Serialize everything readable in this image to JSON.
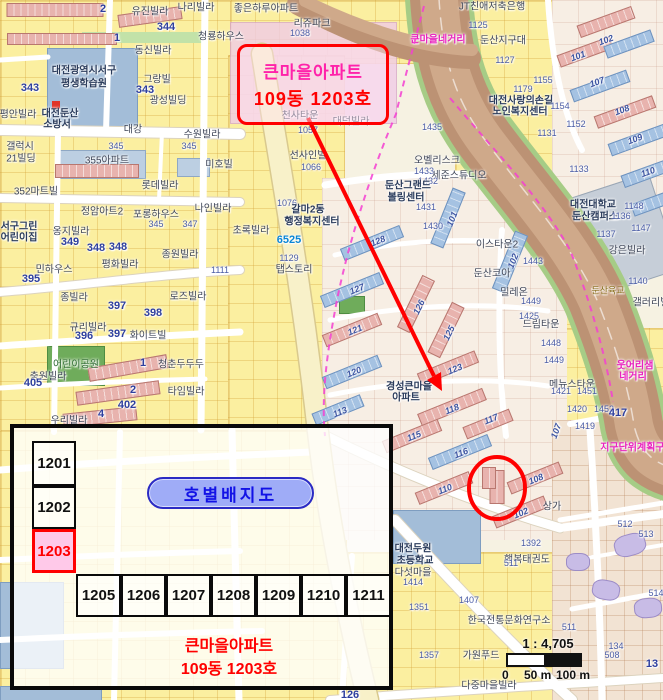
{
  "colors": {
    "red": "#FF0000",
    "magenta_boundary": "#F43FD2",
    "callout_pink": "#FF22AA",
    "pill_fill": "#9FACF7",
    "pill_text": "#1212E6",
    "highlight_fill": "#FFC9E9",
    "road_label_magenta": "#E823BE"
  },
  "callout": {
    "line1": "큰마을아파트",
    "line2": "109동 1203호"
  },
  "inset": {
    "title": "호별배지도",
    "left_units": [
      "1201",
      "1202",
      "1203"
    ],
    "highlight": "1203",
    "row_units": [
      "1205",
      "1206",
      "1207",
      "1208",
      "1209",
      "1210",
      "1211"
    ],
    "caption_line1": "큰마을아파트",
    "caption_line2": "109동 1203호"
  },
  "scalebar": {
    "ratio": "1 : 4,705",
    "tick_0": "0",
    "tick_50": "50 m",
    "tick_100": "100 m"
  },
  "map": {
    "labels": [
      {
        "t": "유진빌라",
        "x": 150,
        "y": 10
      },
      {
        "t": "나리빌라",
        "x": 196,
        "y": 6
      },
      {
        "t": "동신빌라",
        "x": 153,
        "y": 49
      },
      {
        "t": "청룡하우스",
        "x": 221,
        "y": 35
      },
      {
        "t": "344",
        "x": 166,
        "y": 27,
        "c": "numb"
      },
      {
        "t": "대전광역시서구",
        "x": 84,
        "y": 69,
        "c": "civic"
      },
      {
        "t": "평생학습원",
        "x": 84,
        "y": 82,
        "c": "civic"
      },
      {
        "t": "그랑빌",
        "x": 157,
        "y": 78
      },
      {
        "t": "343",
        "x": 30,
        "y": 88,
        "c": "numb"
      },
      {
        "t": "343",
        "x": 145,
        "y": 90,
        "c": "numb"
      },
      {
        "t": "광성빌딩",
        "x": 168,
        "y": 99
      },
      {
        "t": "평안빌라",
        "x": 18,
        "y": 113
      },
      {
        "t": "대전둔산",
        "x": 60,
        "y": 112,
        "c": "civic"
      },
      {
        "t": "소방서",
        "x": 57,
        "y": 123,
        "c": "civic"
      },
      {
        "t": "수원빌라",
        "x": 202,
        "y": 133
      },
      {
        "t": "대강",
        "x": 133,
        "y": 128
      },
      {
        "t": "갤럭시",
        "x": 20,
        "y": 145
      },
      {
        "t": "21빌딩",
        "x": 21,
        "y": 157
      },
      {
        "t": "345",
        "x": 116,
        "y": 146,
        "c": "num"
      },
      {
        "t": "345",
        "x": 189,
        "y": 146,
        "c": "num"
      },
      {
        "t": "355아파트",
        "x": 107,
        "y": 159
      },
      {
        "t": "미호빌",
        "x": 219,
        "y": 163
      },
      {
        "t": "롯데빌라",
        "x": 160,
        "y": 184
      },
      {
        "t": "352마트빌",
        "x": 36,
        "y": 190
      },
      {
        "t": "2",
        "x": 103,
        "y": 9,
        "c": "numb"
      },
      {
        "t": "1",
        "x": 117,
        "y": 38,
        "c": "numb"
      },
      {
        "t": "좋은하루아파트",
        "x": 266,
        "y": 7
      },
      {
        "t": "리쥬파크",
        "x": 312,
        "y": 22
      },
      {
        "t": "1038",
        "x": 300,
        "y": 33,
        "c": "num"
      },
      {
        "t": "큰마을네거리",
        "x": 438,
        "y": 38,
        "c": "mag"
      },
      {
        "t": "JT친애저축은행",
        "x": 492,
        "y": 5
      },
      {
        "t": "1125",
        "x": 478,
        "y": 25,
        "c": "num"
      },
      {
        "t": "둔산지구대",
        "x": 503,
        "y": 39
      },
      {
        "t": "1127",
        "x": 505,
        "y": 60,
        "c": "num"
      },
      {
        "t": "1155",
        "x": 543,
        "y": 80,
        "c": "num"
      },
      {
        "t": "1179",
        "x": 523,
        "y": 89,
        "c": "num"
      },
      {
        "t": "대전사랑의손길",
        "x": 521,
        "y": 99,
        "c": "civic"
      },
      {
        "t": "노인복지센터",
        "x": 520,
        "y": 110,
        "c": "civic"
      },
      {
        "t": "1154",
        "x": 560,
        "y": 106,
        "c": "num"
      },
      {
        "t": "1152",
        "x": 576,
        "y": 124,
        "c": "num"
      },
      {
        "t": "1131",
        "x": 547,
        "y": 133,
        "c": "num"
      },
      {
        "t": "1133",
        "x": 579,
        "y": 169,
        "c": "num"
      },
      {
        "t": "101",
        "x": 578,
        "y": 56,
        "c": "bn",
        "r": -20
      },
      {
        "t": "102",
        "x": 606,
        "y": 40,
        "c": "bn",
        "r": -20
      },
      {
        "t": "107",
        "x": 597,
        "y": 82,
        "c": "bn",
        "r": -20
      },
      {
        "t": "108",
        "x": 622,
        "y": 110,
        "c": "bn",
        "r": -20
      },
      {
        "t": "109",
        "x": 635,
        "y": 139,
        "c": "bn",
        "r": -20
      },
      {
        "t": "110",
        "x": 648,
        "y": 172,
        "c": "bn",
        "r": -20
      },
      {
        "t": "천사타운",
        "x": 300,
        "y": 114
      },
      {
        "t": "대덕빌라",
        "x": 351,
        "y": 120
      },
      {
        "t": "1057",
        "x": 308,
        "y": 130,
        "c": "num"
      },
      {
        "t": "선사인빌",
        "x": 308,
        "y": 154
      },
      {
        "t": "1066",
        "x": 311,
        "y": 167,
        "c": "num"
      },
      {
        "t": "1435",
        "x": 432,
        "y": 127,
        "c": "num"
      },
      {
        "t": "오벨리스크",
        "x": 437,
        "y": 159
      },
      {
        "t": "1433",
        "x": 424,
        "y": 171,
        "c": "num"
      },
      {
        "t": "세준스튜디오",
        "x": 459,
        "y": 174
      },
      {
        "t": "1432",
        "x": 428,
        "y": 181,
        "c": "num"
      },
      {
        "t": "둔산그랜드",
        "x": 408,
        "y": 184,
        "c": "civic"
      },
      {
        "t": "볼링센터",
        "x": 406,
        "y": 196,
        "c": "civic"
      },
      {
        "t": "1431",
        "x": 426,
        "y": 207,
        "c": "num"
      },
      {
        "t": "1430",
        "x": 433,
        "y": 226,
        "c": "num"
      },
      {
        "t": "1076",
        "x": 287,
        "y": 203,
        "c": "num"
      },
      {
        "t": "갈마2동",
        "x": 308,
        "y": 208,
        "c": "civic"
      },
      {
        "t": "행정복지센터",
        "x": 312,
        "y": 220,
        "c": "civic"
      },
      {
        "t": "초록빌라",
        "x": 251,
        "y": 229
      },
      {
        "t": "6525",
        "x": 289,
        "y": 240,
        "c": "cyan"
      },
      {
        "t": "1129",
        "x": 289,
        "y": 258,
        "c": "num"
      },
      {
        "t": "탭스토리",
        "x": 294,
        "y": 268
      },
      {
        "t": "128",
        "x": 378,
        "y": 241,
        "c": "bn",
        "r": -22
      },
      {
        "t": "101",
        "x": 452,
        "y": 219,
        "c": "bn",
        "r": -68
      },
      {
        "t": "102",
        "x": 513,
        "y": 261,
        "c": "bn",
        "r": -68
      },
      {
        "t": "127",
        "x": 357,
        "y": 289,
        "c": "bn",
        "r": -22
      },
      {
        "t": "126",
        "x": 419,
        "y": 307,
        "c": "bn",
        "r": -64
      },
      {
        "t": "121",
        "x": 355,
        "y": 330,
        "c": "bn",
        "r": -22
      },
      {
        "t": "125",
        "x": 449,
        "y": 333,
        "c": "bn",
        "r": -64
      },
      {
        "t": "120",
        "x": 354,
        "y": 372,
        "c": "bn",
        "r": -22
      },
      {
        "t": "123",
        "x": 455,
        "y": 369,
        "c": "bn",
        "r": -22
      },
      {
        "t": "113",
        "x": 340,
        "y": 412,
        "c": "bn",
        "r": -22
      },
      {
        "t": "118",
        "x": 452,
        "y": 409,
        "c": "bn",
        "r": -22
      },
      {
        "t": "117",
        "x": 491,
        "y": 419,
        "c": "bn",
        "r": -22
      },
      {
        "t": "115",
        "x": 414,
        "y": 436,
        "c": "bn",
        "r": -22
      },
      {
        "t": "116",
        "x": 461,
        "y": 453,
        "c": "bn",
        "r": -22
      },
      {
        "t": "110",
        "x": 445,
        "y": 489,
        "c": "bn",
        "r": -22
      },
      {
        "t": "108",
        "x": 536,
        "y": 479,
        "c": "bn",
        "r": -22
      },
      {
        "t": "102",
        "x": 521,
        "y": 513,
        "c": "bn",
        "r": -22
      },
      {
        "t": "107",
        "x": 556,
        "y": 431,
        "c": "bn",
        "r": -70
      },
      {
        "t": "경성큰마을",
        "x": 409,
        "y": 385,
        "c": "civic"
      },
      {
        "t": "아파트",
        "x": 406,
        "y": 396,
        "c": "civic"
      },
      {
        "t": "상가",
        "x": 552,
        "y": 505
      },
      {
        "t": "정암아트2",
        "x": 102,
        "y": 210
      },
      {
        "t": "포롱하우스",
        "x": 156,
        "y": 213
      },
      {
        "t": "나인빌라",
        "x": 213,
        "y": 207
      },
      {
        "t": "345",
        "x": 156,
        "y": 224,
        "c": "num"
      },
      {
        "t": "347",
        "x": 190,
        "y": 224,
        "c": "num"
      },
      {
        "t": "서구그린",
        "x": 19,
        "y": 225,
        "c": "civic"
      },
      {
        "t": "어린이집",
        "x": 19,
        "y": 236,
        "c": "civic"
      },
      {
        "t": "옹지빌라",
        "x": 71,
        "y": 230
      },
      {
        "t": "349",
        "x": 70,
        "y": 242,
        "c": "numb"
      },
      {
        "t": "348",
        "x": 96,
        "y": 248,
        "c": "numb"
      },
      {
        "t": "348",
        "x": 118,
        "y": 247,
        "c": "numb"
      },
      {
        "t": "종원빌라",
        "x": 180,
        "y": 253
      },
      {
        "t": "평화빌라",
        "x": 120,
        "y": 263
      },
      {
        "t": "민하우스",
        "x": 54,
        "y": 268
      },
      {
        "t": "395",
        "x": 31,
        "y": 279,
        "c": "numb"
      },
      {
        "t": "1111",
        "x": 220,
        "y": 270,
        "c": "num"
      },
      {
        "t": "종빌라",
        "x": 74,
        "y": 296
      },
      {
        "t": "로즈빌라",
        "x": 188,
        "y": 295
      },
      {
        "t": "397",
        "x": 117,
        "y": 306,
        "c": "numb"
      },
      {
        "t": "398",
        "x": 153,
        "y": 313,
        "c": "numb"
      },
      {
        "t": "규리빌라",
        "x": 88,
        "y": 326
      },
      {
        "t": "396",
        "x": 84,
        "y": 336,
        "c": "numb"
      },
      {
        "t": "397",
        "x": 117,
        "y": 334,
        "c": "numb"
      },
      {
        "t": "화이트빌",
        "x": 148,
        "y": 334
      },
      {
        "t": "어린이공원",
        "x": 76,
        "y": 363,
        "c": "green"
      },
      {
        "t": "충원빌라",
        "x": 48,
        "y": 375
      },
      {
        "t": "405",
        "x": 33,
        "y": 383,
        "c": "numb"
      },
      {
        "t": "청춘두두두",
        "x": 181,
        "y": 363
      },
      {
        "t": "타임빌라",
        "x": 186,
        "y": 390
      },
      {
        "t": "402",
        "x": 127,
        "y": 405,
        "c": "numb"
      },
      {
        "t": "우리빌라",
        "x": 69,
        "y": 419
      },
      {
        "t": "1",
        "x": 143,
        "y": 363,
        "c": "numb"
      },
      {
        "t": "2",
        "x": 133,
        "y": 390,
        "c": "numb"
      },
      {
        "t": "4",
        "x": 101,
        "y": 414,
        "c": "numb"
      },
      {
        "t": "이스타운2",
        "x": 497,
        "y": 243
      },
      {
        "t": "둔산코아",
        "x": 492,
        "y": 272
      },
      {
        "t": "1443",
        "x": 533,
        "y": 261,
        "c": "num"
      },
      {
        "t": "밀레온",
        "x": 514,
        "y": 291
      },
      {
        "t": "1449",
        "x": 531,
        "y": 301,
        "c": "num"
      },
      {
        "t": "1425",
        "x": 529,
        "y": 316,
        "c": "num"
      },
      {
        "t": "드림타운",
        "x": 541,
        "y": 323
      },
      {
        "t": "1448",
        "x": 551,
        "y": 343,
        "c": "num"
      },
      {
        "t": "1449",
        "x": 554,
        "y": 360,
        "c": "num"
      },
      {
        "t": "대전대학교",
        "x": 593,
        "y": 203,
        "c": "civic"
      },
      {
        "t": "둔산캠퍼스",
        "x": 595,
        "y": 215,
        "c": "civic"
      },
      {
        "t": "1136",
        "x": 621,
        "y": 216,
        "c": "num"
      },
      {
        "t": "1148",
        "x": 634,
        "y": 206,
        "c": "num"
      },
      {
        "t": "1137",
        "x": 606,
        "y": 234,
        "c": "num"
      },
      {
        "t": "1147",
        "x": 641,
        "y": 228,
        "c": "num"
      },
      {
        "t": "강은빌라",
        "x": 627,
        "y": 249
      },
      {
        "t": "1140",
        "x": 638,
        "y": 281,
        "c": "num"
      },
      {
        "t": "갤러리빌",
        "x": 651,
        "y": 301
      },
      {
        "t": "둔산육교",
        "x": 608,
        "y": 290,
        "c": "olive"
      },
      {
        "t": "메뉴스타운",
        "x": 572,
        "y": 383
      },
      {
        "t": "1421",
        "x": 561,
        "y": 391,
        "c": "num"
      },
      {
        "t": "1451",
        "x": 587,
        "y": 391,
        "c": "num"
      },
      {
        "t": "1420",
        "x": 577,
        "y": 409,
        "c": "num"
      },
      {
        "t": "1452",
        "x": 604,
        "y": 409,
        "c": "num"
      },
      {
        "t": "417",
        "x": 618,
        "y": 413,
        "c": "numb"
      },
      {
        "t": "1419",
        "x": 585,
        "y": 426,
        "c": "num"
      },
      {
        "t": "웃어리샘",
        "x": 635,
        "y": 364,
        "c": "mag"
      },
      {
        "t": "네거리",
        "x": 633,
        "y": 375,
        "c": "mag"
      },
      {
        "t": "지구단위계획구역",
        "x": 637,
        "y": 446,
        "c": "mag"
      },
      {
        "t": "대전두원",
        "x": 413,
        "y": 547,
        "c": "civic"
      },
      {
        "t": "초등학교",
        "x": 415,
        "y": 559,
        "c": "civic"
      },
      {
        "t": "행복태권도",
        "x": 527,
        "y": 558
      },
      {
        "t": "1392",
        "x": 531,
        "y": 543,
        "c": "num"
      },
      {
        "t": "다섯마을",
        "x": 413,
        "y": 571
      },
      {
        "t": "1414",
        "x": 413,
        "y": 582,
        "c": "num"
      },
      {
        "t": "1407",
        "x": 469,
        "y": 600,
        "c": "num"
      },
      {
        "t": "1351",
        "x": 419,
        "y": 607,
        "c": "num"
      },
      {
        "t": "한국전통문화연구소",
        "x": 509,
        "y": 619
      },
      {
        "t": "가원푸드",
        "x": 481,
        "y": 654
      },
      {
        "t": "1357",
        "x": 429,
        "y": 655,
        "c": "num"
      },
      {
        "t": "다중마을빌라",
        "x": 489,
        "y": 684
      },
      {
        "t": "511",
        "x": 511,
        "y": 563,
        "c": "num"
      },
      {
        "t": "511",
        "x": 569,
        "y": 627,
        "c": "num"
      },
      {
        "t": "512",
        "x": 625,
        "y": 524,
        "c": "num"
      },
      {
        "t": "513",
        "x": 646,
        "y": 534,
        "c": "num"
      },
      {
        "t": "514",
        "x": 656,
        "y": 593,
        "c": "num"
      },
      {
        "t": "508",
        "x": 612,
        "y": 655,
        "c": "num"
      },
      {
        "t": "13",
        "x": 652,
        "y": 664,
        "c": "numb"
      },
      {
        "t": "134",
        "x": 616,
        "y": 646,
        "c": "num"
      },
      {
        "t": "126",
        "x": 350,
        "y": 695,
        "c": "numb"
      }
    ]
  }
}
